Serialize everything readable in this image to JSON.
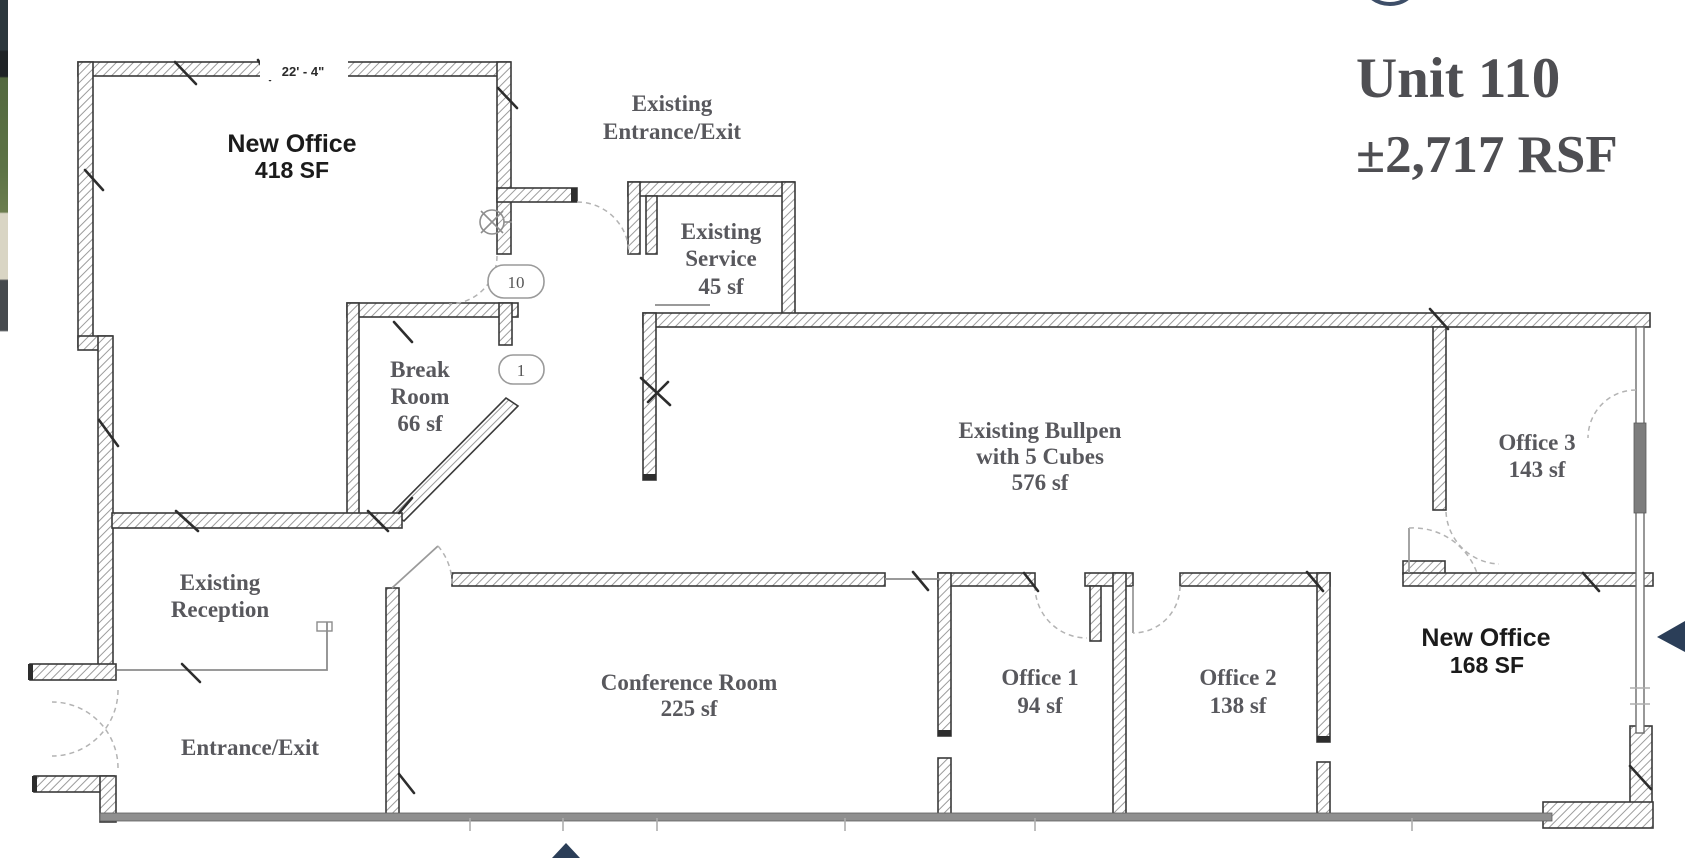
{
  "title": {
    "line1": "Unit 110",
    "line2": "±2,717 RSF"
  },
  "floor_plan": {
    "dimension_label": "22' - 4\"",
    "rooms": {
      "new_office_main": {
        "name": "New Office",
        "area": "418 SF"
      },
      "entrance_corridor": {
        "line1": "Existing",
        "line2": "Entrance/Exit"
      },
      "existing_service": {
        "line1": "Existing",
        "line2": "Service",
        "area": "45 sf"
      },
      "break_room": {
        "line1": "Break",
        "line2": "Room",
        "area": "66 sf"
      },
      "bullpen": {
        "line1": "Existing Bullpen",
        "line2": "with 5 Cubes",
        "area": "576 sf"
      },
      "office_3": {
        "name": "Office 3",
        "area": "143 sf"
      },
      "reception": {
        "line1": "Existing",
        "line2": "Reception"
      },
      "conference": {
        "name": "Conference Room",
        "area": "225 sf"
      },
      "office_1": {
        "name": "Office 1",
        "area": "94 sf"
      },
      "office_2": {
        "name": "Office 2",
        "area": "138 sf"
      },
      "new_office_2": {
        "name": "New Office",
        "area": "168 SF"
      },
      "entrance": {
        "name": "Entrance/Exit"
      }
    },
    "door_tags": {
      "tag_10": "10",
      "tag_1": "1"
    }
  },
  "icons": {
    "left_arrow": "◀",
    "up_arrow": "▲",
    "partial_circle": "◯"
  },
  "colors": {
    "accent_navy": "#2b3e58",
    "label_serif": "#58585d",
    "label_sans": "#1b1b1b",
    "wall_line": "#3a3a3a",
    "bottom_wall": "#8f8f8f",
    "title_text": "#4e4e52",
    "strip_green": "#5d7346",
    "strip_beige": "#d9d5c4",
    "strip_dark": "#2c373d"
  }
}
